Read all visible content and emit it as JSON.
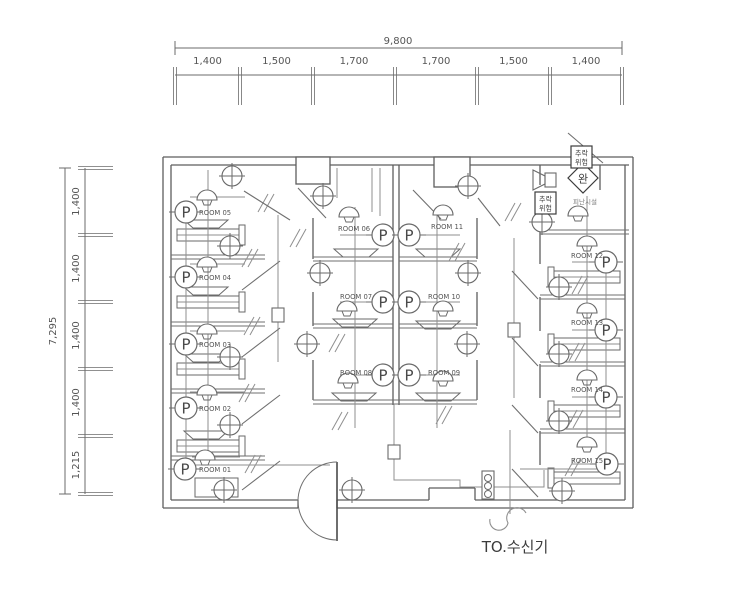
{
  "drawing": {
    "receiver_label": "TO.수신기",
    "descender_symbol": "완",
    "fall_warning": "추락위험",
    "evac_label": "피난시설",
    "colors": {
      "wall": "#5e5e5e",
      "partition": "#6f6f6f",
      "wire": "#8f8f8f",
      "symbol": "#6a6a6a",
      "text": "#555555",
      "dim": "#6b6b6b",
      "dark_text": "#3c3c3c"
    },
    "dim_top": {
      "total": "9,800",
      "labels": [
        "1,400",
        "1,500",
        "1,700",
        "1,700",
        "1,500",
        "1,400"
      ],
      "ticks": [
        175,
        240,
        313,
        395,
        477,
        550,
        622
      ],
      "total_y": 48,
      "line_y": 75,
      "label_y": 64,
      "total_label_x": 398,
      "total_label_y": 44
    },
    "dim_left": {
      "total": "7,295",
      "labels": [
        "1,400",
        "1,400",
        "1,400",
        "1,400",
        "1,215"
      ],
      "ticks": [
        168,
        235,
        302,
        369,
        436,
        494
      ],
      "total_x": 65,
      "line_x": 85,
      "label_x": 79,
      "total_label_x": 56,
      "total_label_y": 331
    },
    "rooms": [
      {
        "label": "ROOM 05",
        "x": 199,
        "y": 215
      },
      {
        "label": "ROOM 04",
        "x": 199,
        "y": 280
      },
      {
        "label": "ROOM 03",
        "x": 199,
        "y": 347
      },
      {
        "label": "ROOM 02",
        "x": 199,
        "y": 411
      },
      {
        "label": "ROOM 01",
        "x": 199,
        "y": 472
      },
      {
        "label": "ROOM 06",
        "x": 338,
        "y": 231
      },
      {
        "label": "ROOM 07",
        "x": 340,
        "y": 299
      },
      {
        "label": "ROOM 08",
        "x": 340,
        "y": 375
      },
      {
        "label": "ROOM 11",
        "x": 431,
        "y": 229
      },
      {
        "label": "ROOM 10",
        "x": 428,
        "y": 299
      },
      {
        "label": "ROOM 09",
        "x": 428,
        "y": 375
      },
      {
        "label": "ROOM 12",
        "x": 571,
        "y": 258
      },
      {
        "label": "ROOM 13",
        "x": 571,
        "y": 325
      },
      {
        "label": "ROOM 14",
        "x": 571,
        "y": 392
      },
      {
        "label": "ROOM 15",
        "x": 571,
        "y": 463
      }
    ],
    "wall_lines": [
      [
        163,
        157,
        633,
        157
      ],
      [
        163,
        157,
        163,
        508
      ],
      [
        633,
        157,
        633,
        508
      ],
      [
        163,
        508,
        298,
        508
      ],
      [
        337,
        508,
        633,
        508
      ],
      [
        171,
        165,
        629,
        165
      ],
      [
        171,
        165,
        171,
        500
      ],
      [
        625,
        165,
        625,
        500
      ],
      [
        171,
        500,
        298,
        500
      ],
      [
        337,
        500,
        429,
        500
      ],
      [
        475,
        500,
        625,
        500
      ],
      [
        429,
        488,
        475,
        488
      ],
      [
        429,
        488,
        429,
        500
      ],
      [
        475,
        488,
        475,
        500
      ],
      [
        298,
        500,
        298,
        508
      ],
      [
        337,
        500,
        337,
        508
      ],
      [
        393,
        165,
        393,
        405
      ],
      [
        399,
        165,
        399,
        405
      ],
      [
        313,
        218,
        313,
        259
      ],
      [
        313,
        292,
        313,
        326
      ],
      [
        313,
        360,
        313,
        400
      ],
      [
        477,
        218,
        477,
        259
      ],
      [
        477,
        292,
        477,
        326
      ],
      [
        477,
        360,
        477,
        400
      ],
      [
        540,
        232,
        540,
        264
      ],
      [
        540,
        297,
        540,
        331
      ],
      [
        540,
        364,
        540,
        398
      ],
      [
        540,
        431,
        540,
        465
      ],
      [
        540,
        165,
        540,
        185
      ],
      [
        600,
        165,
        600,
        190
      ]
    ],
    "partitions": [
      [
        171,
        257,
        265,
        257
      ],
      [
        171,
        324,
        265,
        324
      ],
      [
        171,
        391,
        265,
        391
      ],
      [
        171,
        458,
        265,
        458
      ],
      [
        313,
        259,
        393,
        259
      ],
      [
        399,
        259,
        477,
        259
      ],
      [
        313,
        326,
        393,
        326
      ],
      [
        399,
        326,
        477,
        326
      ],
      [
        313,
        402,
        477,
        402
      ],
      [
        540,
        297,
        625,
        297
      ],
      [
        540,
        364,
        625,
        364
      ],
      [
        540,
        431,
        625,
        431
      ],
      [
        540,
        232,
        629,
        232
      ]
    ],
    "piers": [
      [
        296,
        157,
        34,
        27
      ],
      [
        434,
        157,
        36,
        30
      ]
    ],
    "beds": [
      [
        177,
        229,
        62,
        12
      ],
      [
        177,
        296,
        62,
        12
      ],
      [
        177,
        363,
        62,
        12
      ],
      [
        177,
        440,
        62,
        12
      ],
      [
        554,
        271,
        66,
        12
      ],
      [
        554,
        338,
        66,
        12
      ],
      [
        554,
        405,
        66,
        12
      ],
      [
        554,
        472,
        66,
        12
      ]
    ],
    "headboards": [
      [
        239,
        225,
        6,
        20
      ],
      [
        239,
        292,
        6,
        20
      ],
      [
        239,
        359,
        6,
        20
      ],
      [
        239,
        436,
        6,
        20
      ],
      [
        548,
        267,
        6,
        20
      ],
      [
        548,
        334,
        6,
        20
      ],
      [
        548,
        401,
        6,
        20
      ],
      [
        548,
        468,
        6,
        20
      ]
    ],
    "nightstand": [
      195,
      478,
      43,
      19
    ],
    "sinks": [
      [
        356,
        253
      ],
      [
        438,
        253
      ],
      [
        355,
        323
      ],
      [
        438,
        325
      ],
      [
        354,
        397
      ],
      [
        438,
        397
      ],
      [
        206,
        224
      ],
      [
        206,
        291
      ],
      [
        206,
        358
      ],
      [
        206,
        435
      ]
    ],
    "wires": [
      [
        [
          208,
          170
        ],
        [
          208,
          452
        ]
      ],
      [
        [
          186,
          223
        ],
        [
          186,
          468
        ]
      ],
      [
        [
          190,
          197
        ],
        [
          245,
          197
        ]
      ],
      [
        [
          190,
          264
        ],
        [
          245,
          264
        ]
      ],
      [
        [
          190,
          331
        ],
        [
          245,
          331
        ]
      ],
      [
        [
          190,
          392
        ],
        [
          245,
          392
        ]
      ],
      [
        [
          192,
          457
        ],
        [
          240,
          457
        ]
      ],
      [
        [
          355,
          207
        ],
        [
          355,
          428
        ]
      ],
      [
        [
          437,
          207
        ],
        [
          437,
          428
        ]
      ],
      [
        [
          340,
          235
        ],
        [
          460,
          235
        ]
      ],
      [
        [
          340,
          302
        ],
        [
          460,
          302
        ]
      ],
      [
        [
          340,
          375
        ],
        [
          460,
          375
        ]
      ],
      [
        [
          337,
          168
        ],
        [
          337,
          198
        ]
      ],
      [
        [
          372,
          168
        ],
        [
          372,
          212
        ]
      ],
      [
        [
          380,
          168
        ],
        [
          380,
          216
        ]
      ],
      [
        [
          587,
          226
        ],
        [
          587,
          446
        ]
      ],
      [
        [
          606,
          270
        ],
        [
          606,
          458
        ]
      ],
      [
        [
          572,
          262
        ],
        [
          596,
          262
        ]
      ],
      [
        [
          572,
          330
        ],
        [
          596,
          330
        ]
      ],
      [
        [
          572,
          397
        ],
        [
          596,
          397
        ]
      ],
      [
        [
          572,
          464
        ],
        [
          597,
          464
        ]
      ],
      [
        [
          196,
          465
        ],
        [
          330,
          465
        ]
      ],
      [
        [
          278,
          215
        ],
        [
          278,
          308
        ]
      ],
      [
        [
          278,
          322
        ],
        [
          278,
          362
        ]
      ],
      [
        [
          514,
          238
        ],
        [
          514,
          323
        ]
      ],
      [
        [
          514,
          337
        ],
        [
          514,
          398
        ]
      ],
      [
        [
          394,
          404
        ],
        [
          394,
          445
        ]
      ],
      [
        [
          394,
          458
        ],
        [
          394,
          480
        ],
        [
          460,
          480
        ],
        [
          460,
          487
        ],
        [
          482,
          487
        ]
      ],
      [
        [
          494,
          487
        ],
        [
          544,
          487
        ],
        [
          544,
          470
        ]
      ],
      [
        [
          520,
          469
        ],
        [
          600,
          469
        ]
      ],
      [
        [
          510,
          430
        ],
        [
          510,
          514
        ]
      ],
      [
        [
          587,
          196
        ],
        [
          587,
          226
        ]
      ]
    ],
    "slashes": [
      [
        266,
        203
      ],
      [
        513,
        212
      ],
      [
        250,
        258
      ],
      [
        252,
        326
      ],
      [
        247,
        393
      ],
      [
        253,
        464
      ],
      [
        337,
        343
      ],
      [
        340,
        421
      ],
      [
        444,
        415
      ],
      [
        457,
        252
      ],
      [
        580,
        285
      ],
      [
        577,
        352
      ],
      [
        575,
        419
      ],
      [
        573,
        467
      ],
      [
        298,
        238
      ]
    ],
    "doors": [
      [
        244,
        191,
        290,
        220
      ],
      [
        242,
        290,
        280,
        261
      ],
      [
        242,
        357,
        280,
        328
      ],
      [
        242,
        424,
        280,
        395
      ],
      [
        242,
        490,
        280,
        461
      ],
      [
        298,
        188,
        326,
        218
      ],
      [
        413,
        190,
        441,
        219
      ],
      [
        538,
        299,
        512,
        271
      ],
      [
        538,
        366,
        512,
        338
      ],
      [
        538,
        433,
        512,
        405
      ],
      [
        538,
        497,
        512,
        469
      ],
      [
        478,
        198,
        500,
        226
      ],
      [
        568,
        133,
        603,
        163
      ]
    ],
    "entry_door": {
      "leaf": [
        337,
        462,
        337,
        541
      ],
      "arc": "M337,462 A39,39 0 0 0 337,540"
    },
    "p_units": [
      [
        186,
        212
      ],
      [
        186,
        277
      ],
      [
        186,
        344
      ],
      [
        186,
        408
      ],
      [
        185,
        469
      ],
      [
        383,
        235
      ],
      [
        409,
        235
      ],
      [
        383,
        302
      ],
      [
        409,
        302
      ],
      [
        383,
        375
      ],
      [
        409,
        375
      ],
      [
        606,
        262
      ],
      [
        606,
        330
      ],
      [
        606,
        397
      ],
      [
        607,
        464
      ]
    ],
    "smoke_detectors": [
      [
        207,
        197
      ],
      [
        207,
        264
      ],
      [
        207,
        331
      ],
      [
        207,
        392
      ],
      [
        205,
        457
      ],
      [
        349,
        214
      ],
      [
        347,
        308
      ],
      [
        348,
        380
      ],
      [
        443,
        212
      ],
      [
        443,
        308
      ],
      [
        443,
        378
      ],
      [
        587,
        243
      ],
      [
        587,
        310
      ],
      [
        587,
        377
      ],
      [
        587,
        444
      ],
      [
        578,
        213
      ]
    ],
    "heat_detectors": [
      [
        232,
        176
      ],
      [
        230,
        246
      ],
      [
        230,
        357
      ],
      [
        230,
        425
      ],
      [
        224,
        490
      ],
      [
        323,
        196
      ],
      [
        468,
        186
      ],
      [
        320,
        273
      ],
      [
        468,
        273
      ],
      [
        307,
        344
      ],
      [
        467,
        344
      ],
      [
        559,
        287
      ],
      [
        559,
        354
      ],
      [
        559,
        421
      ],
      [
        562,
        491
      ],
      [
        542,
        222
      ],
      [
        352,
        490
      ]
    ],
    "junction_boxes": [
      [
        272,
        308
      ],
      [
        508,
        323
      ],
      [
        388,
        445
      ]
    ],
    "manual_station": {
      "x": 482,
      "y": 471,
      "w": 12,
      "h": 28
    },
    "speaker": {
      "box": [
        545,
        173,
        11,
        14
      ],
      "horn": "533,170 545,176 545,184 533,190"
    },
    "diamond": {
      "cx": 583,
      "cy": 178,
      "r": 15
    },
    "warn_boxes": [
      [
        571,
        146
      ],
      [
        535,
        192
      ]
    ],
    "evac_pos": {
      "x": 585,
      "y": 204
    },
    "squiggle": "M490,519 A9,9 0 0 0 508,523 A9,9 0 0 1 526,513",
    "receiver_pos": {
      "x": 515,
      "y": 552
    }
  }
}
